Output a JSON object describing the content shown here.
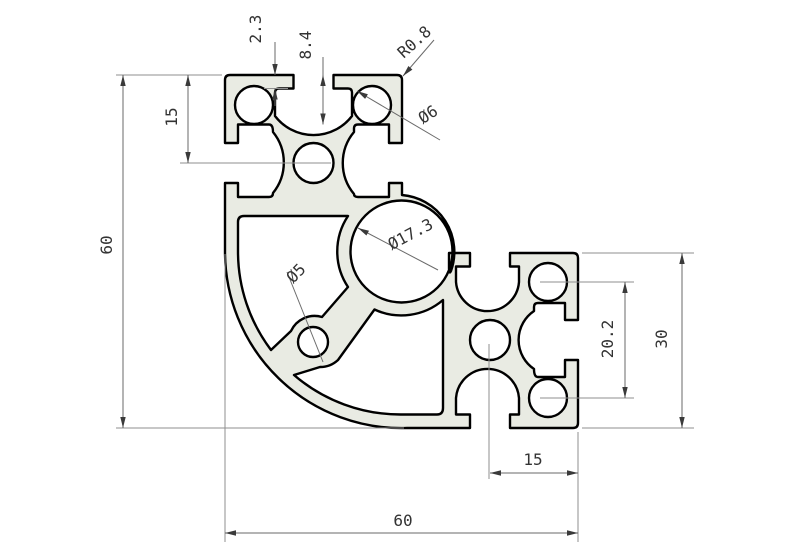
{
  "drawing": {
    "type": "technical-cad-drawing",
    "subject": "aluminum-extrusion-corner-profile-cross-section",
    "labels": {
      "lip_thickness": "2.3",
      "slot_depth": "8.4",
      "corner_radius": "R0.8",
      "slot_hole_dia": "Ø6",
      "hole_offset_left": "15",
      "overall_height": "60",
      "core_bore_dia": "Ø17.3",
      "web_hole_dia": "Ø5",
      "hole_pitch": "20.2",
      "arm_width": "30",
      "slot_offset_bottom": "15",
      "overall_width": "60"
    },
    "colors": {
      "background": "#ffffff",
      "profile_fill": "#e9ebe3",
      "outline": "#000000",
      "dimension_line": "#6a6a6a",
      "extension_line": "#8f8f8f",
      "text": "#333333"
    }
  }
}
